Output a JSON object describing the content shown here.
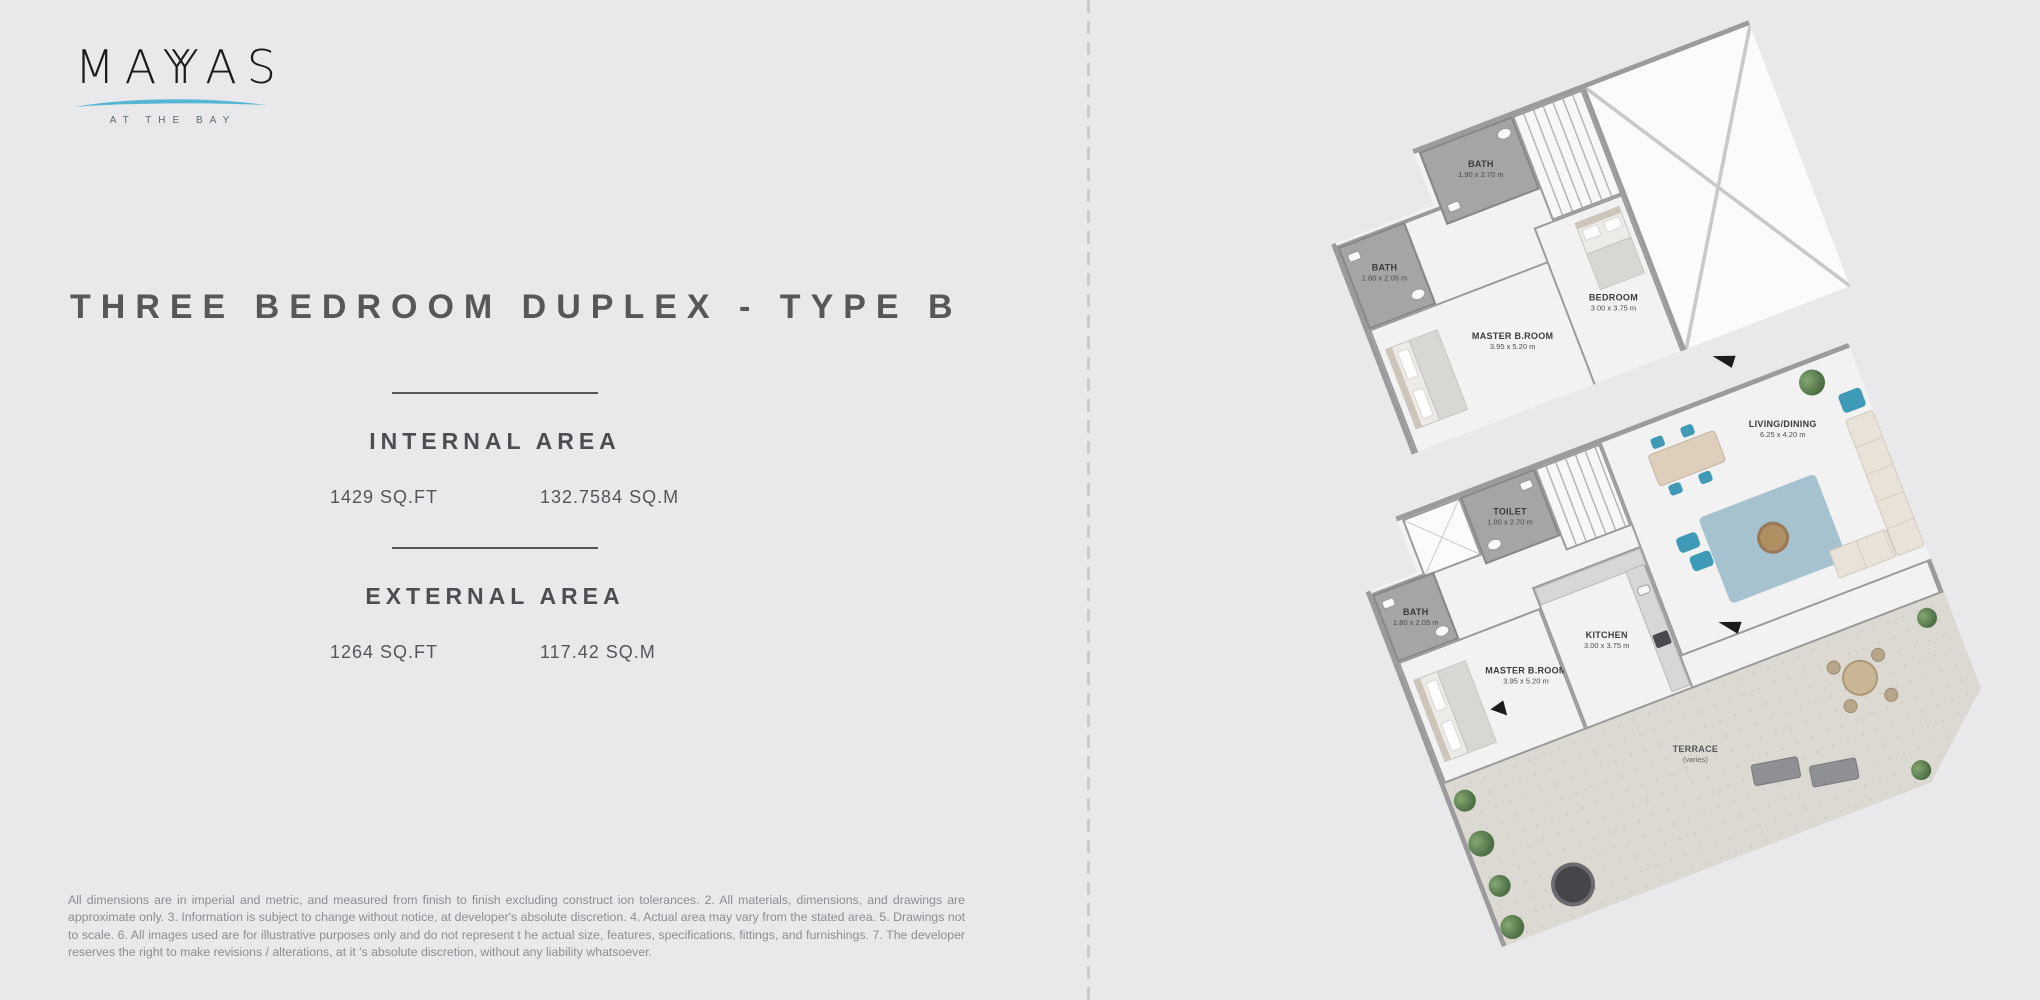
{
  "logo": {
    "part1": "MA",
    "part2": "Y",
    "part3": "Y",
    "part4": "AS",
    "tagline": "AT THE BAY"
  },
  "title": "THREE BEDROOM DUPLEX - TYPE B",
  "internal_area": {
    "heading": "INTERNAL AREA",
    "sqft": "1429 SQ.FT",
    "sqm": "132.7584 SQ.M"
  },
  "external_area": {
    "heading": "EXTERNAL AREA",
    "sqft": "1264 SQ.FT",
    "sqm": "117.42 SQ.M"
  },
  "disclaimer": "All dimensions are in imperial and metric, and measured from finish to finish excluding construct ion tolerances. 2. All materials, dimensions, and drawings are approximate only. 3. Information is subject to change without notice, at developer's absolute discretion. 4. Actual area may vary from the stated area. 5. Drawings not to scale. 6. All images used are for illustrative purposes only and do not represent t he actual size, features, specifications, fittings, and furnishings. 7. The developer reserves the right to make revisions / alterations, at it 's absolute discretion, without any liability whatsoever.",
  "floorplans": {
    "upper": {
      "rooms": {
        "bath1": {
          "label": "BATH",
          "dims": "1.90 x 2.70 m"
        },
        "bath2": {
          "label": "BATH",
          "dims": "1.80 x 2.05 m"
        },
        "master": {
          "label": "MASTER B.ROOM",
          "dims": "3.95 x 5.20 m"
        },
        "bedroom": {
          "label": "BEDROOM",
          "dims": "3.00 x 3.75 m"
        }
      }
    },
    "lower": {
      "rooms": {
        "toilet": {
          "label": "TOILET",
          "dims": "1.00 x 2.70 m"
        },
        "bath": {
          "label": "BATH",
          "dims": "1.80 x 2.05 m"
        },
        "master": {
          "label": "MASTER B.ROOM",
          "dims": "3.95 x 5.20 m"
        },
        "kitchen": {
          "label": "KITCHEN",
          "dims": "3.00 x 3.75 m"
        },
        "living": {
          "label": "LIVING/DINING",
          "dims": "6.25 x 4.20 m"
        },
        "terrace": {
          "label": "TERRACE",
          "dims": "(varies)"
        }
      }
    }
  },
  "colors": {
    "background": "#e9e8ea",
    "accent_teal": "#55b6d2",
    "title_gray": "#57575a",
    "wall_gray": "#9b9b9b",
    "terrace_floor": "#dcd8d2"
  }
}
